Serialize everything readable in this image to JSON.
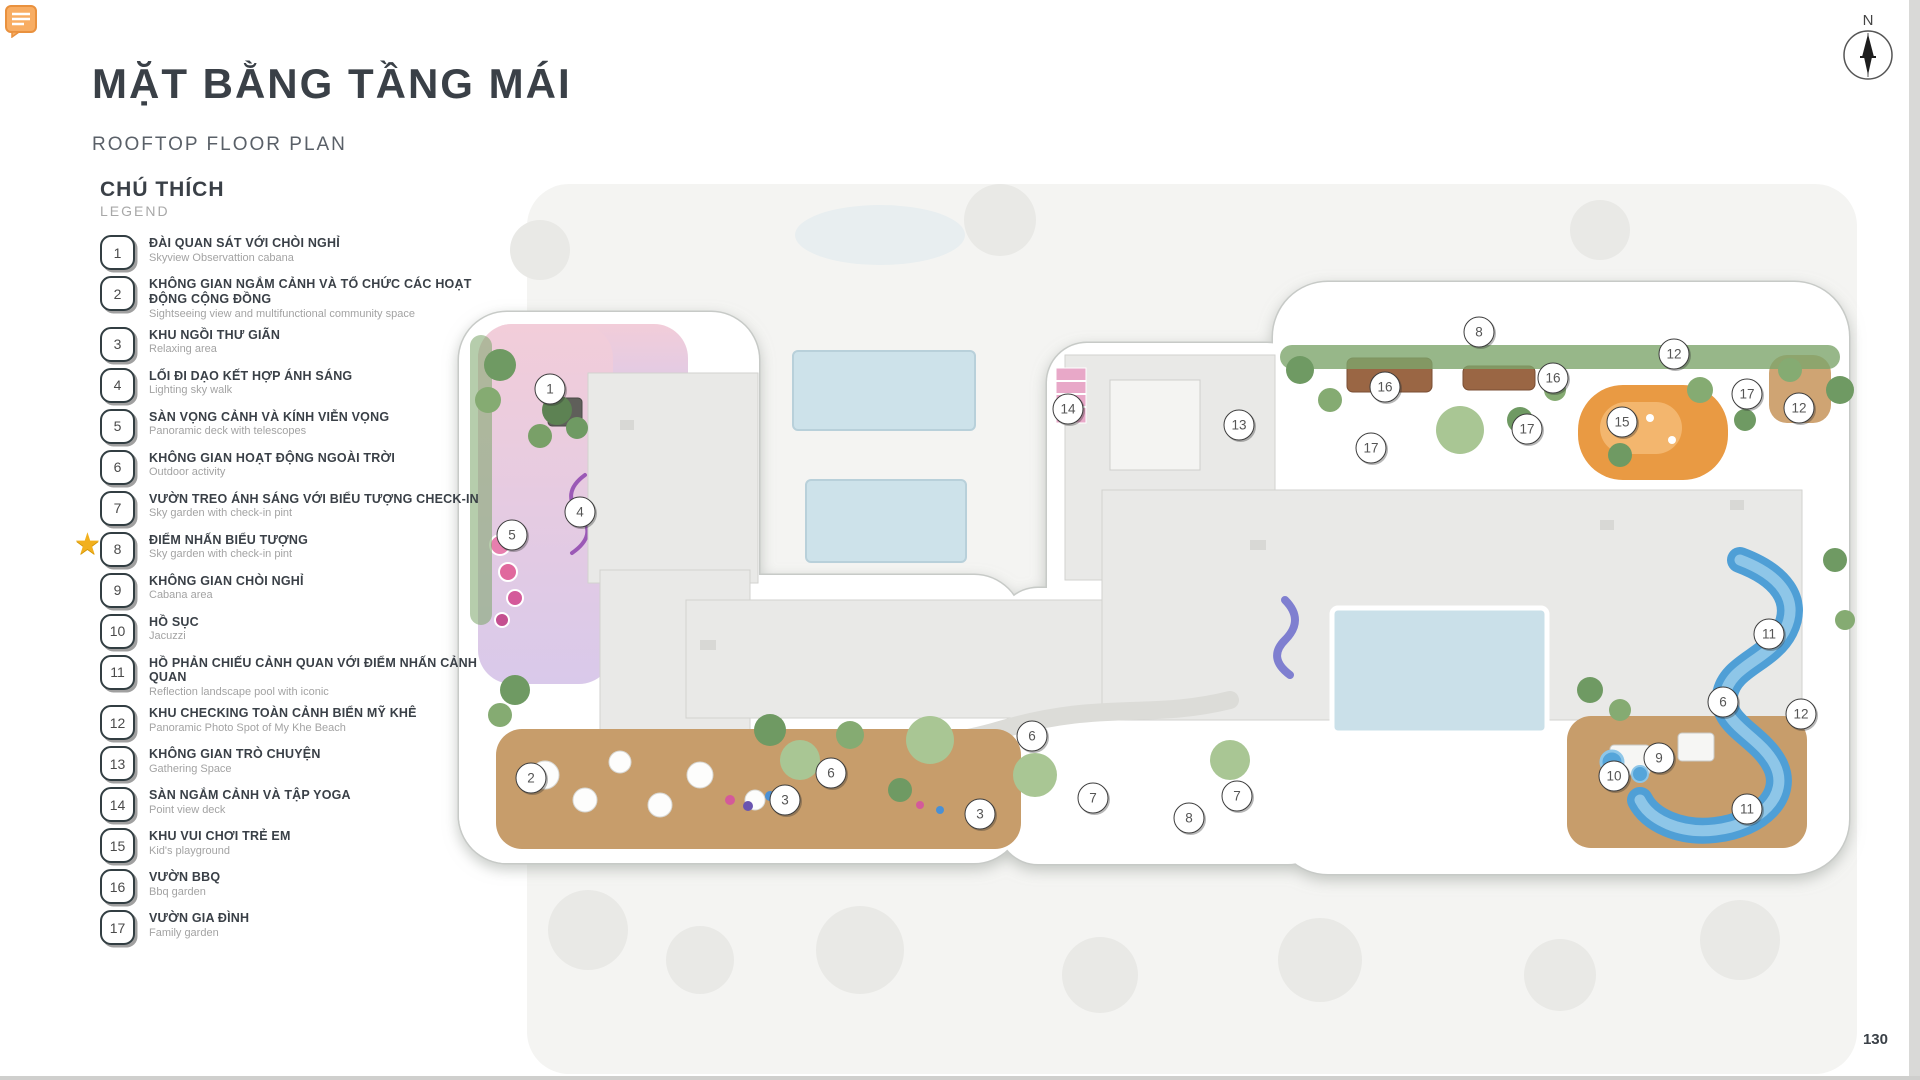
{
  "header": {
    "title_vi": "MẶT BẰNG TẦNG MÁI",
    "title_en": "ROOFTOP FLOOR PLAN"
  },
  "legend": {
    "title_vi": "CHÚ THÍCH",
    "title_en": "LEGEND",
    "items": [
      {
        "num": "1",
        "vi": "ĐÀI QUAN SÁT VỚI CHÒI NGHỈ",
        "en": "Skyview Observattion cabana",
        "starred": false
      },
      {
        "num": "2",
        "vi": "KHÔNG GIAN NGẮM CẢNH VÀ TỔ CHỨC CÁC HOẠT ĐỘNG CỘNG ĐỒNG",
        "en": "Sightseeing view and multifunctional community space",
        "starred": false
      },
      {
        "num": "3",
        "vi": "KHU NGỒI THƯ GIÃN",
        "en": "Relaxing area",
        "starred": false
      },
      {
        "num": "4",
        "vi": "LỐI ĐI DẠO KẾT HỢP ÁNH SÁNG",
        "en": "Lighting sky walk",
        "starred": false
      },
      {
        "num": "5",
        "vi": "SÀN VỌNG CẢNH VÀ KÍNH VIỄN VỌNG",
        "en": "Panoramic deck with telescopes",
        "starred": false
      },
      {
        "num": "6",
        "vi": "KHÔNG GIAN HOẠT ĐỘNG NGOÀI TRỜI",
        "en": "Outdoor activity",
        "starred": false
      },
      {
        "num": "7",
        "vi": "VƯỜN TREO ÁNH SÁNG VỚI BIỂU TƯỢNG CHECK-IN",
        "en": "Sky garden with check-in pint",
        "starred": false
      },
      {
        "num": "8",
        "vi": "ĐIỂM NHẤN BIỂU TƯỢNG",
        "en": "Sky garden with check-in pint",
        "starred": true
      },
      {
        "num": "9",
        "vi": "KHÔNG GIAN CHÒI NGHỈ",
        "en": "Cabana area",
        "starred": false
      },
      {
        "num": "10",
        "vi": "HỒ SỤC",
        "en": "Jacuzzi",
        "starred": false
      },
      {
        "num": "11",
        "vi": "HỒ PHẢN CHIẾU CẢNH QUAN VỚI ĐIỂM NHẤN CẢNH QUAN",
        "en": "Reflection landscape pool with iconic",
        "starred": false
      },
      {
        "num": "12",
        "vi": "KHU CHECKING TOÀN CẢNH BIỂN MỸ KHÊ",
        "en": "Panoramic Photo Spot of My Khe Beach",
        "starred": false
      },
      {
        "num": "13",
        "vi": "KHÔNG GIAN TRÒ CHUYỆN",
        "en": "Gathering Space",
        "starred": false
      },
      {
        "num": "14",
        "vi": "SÀN NGẮM CẢNH VÀ TẬP YOGA",
        "en": "Point view deck",
        "starred": false
      },
      {
        "num": "15",
        "vi": "KHU VUI CHƠI TRẺ EM",
        "en": "Kid's playground",
        "starred": false
      },
      {
        "num": "16",
        "vi": "VƯỜN BBQ",
        "en": "Bbq garden",
        "starred": false
      },
      {
        "num": "17",
        "vi": "VƯỜN GIA ĐÌNH",
        "en": "Family garden",
        "starred": false
      }
    ]
  },
  "compass": {
    "label": "N"
  },
  "page": {
    "number": "130"
  },
  "plan": {
    "markers": [
      {
        "num": "1",
        "x": 550,
        "y": 389
      },
      {
        "num": "4",
        "x": 580,
        "y": 512
      },
      {
        "num": "5",
        "x": 512,
        "y": 535
      },
      {
        "num": "2",
        "x": 531,
        "y": 778
      },
      {
        "num": "3",
        "x": 785,
        "y": 800
      },
      {
        "num": "6",
        "x": 831,
        "y": 773
      },
      {
        "num": "3",
        "x": 980,
        "y": 814
      },
      {
        "num": "6",
        "x": 1032,
        "y": 736
      },
      {
        "num": "7",
        "x": 1093,
        "y": 798
      },
      {
        "num": "8",
        "x": 1189,
        "y": 818
      },
      {
        "num": "7",
        "x": 1237,
        "y": 796
      },
      {
        "num": "14",
        "x": 1068,
        "y": 409
      },
      {
        "num": "13",
        "x": 1239,
        "y": 425
      },
      {
        "num": "16",
        "x": 1385,
        "y": 387
      },
      {
        "num": "17",
        "x": 1371,
        "y": 448
      },
      {
        "num": "16",
        "x": 1553,
        "y": 378
      },
      {
        "num": "17",
        "x": 1527,
        "y": 429
      },
      {
        "num": "8",
        "x": 1479,
        "y": 332
      },
      {
        "num": "15",
        "x": 1622,
        "y": 422
      },
      {
        "num": "12",
        "x": 1674,
        "y": 354
      },
      {
        "num": "17",
        "x": 1747,
        "y": 394
      },
      {
        "num": "12",
        "x": 1799,
        "y": 408
      },
      {
        "num": "11",
        "x": 1769,
        "y": 634
      },
      {
        "num": "6",
        "x": 1723,
        "y": 702
      },
      {
        "num": "12",
        "x": 1801,
        "y": 714
      },
      {
        "num": "9",
        "x": 1659,
        "y": 758
      },
      {
        "num": "10",
        "x": 1614,
        "y": 776
      },
      {
        "num": "11",
        "x": 1747,
        "y": 809
      }
    ]
  },
  "colors": {
    "title_text": "#3a4047",
    "legend_sub_text": "#a3a3a3",
    "star_gold": "#f2b01e",
    "roof_gray": "#e9e9e7",
    "deck_tan": "#c79d6b",
    "pool_pale_blue": "#cde2ea",
    "water_blue": "#4f9fd6",
    "landscape_green": "#6f9a63",
    "playground_orange": "#e99a43",
    "zone_pink": "#f2cdd9",
    "zone_lavender": "#d9c9ea",
    "comment_orange": "#f8ad63"
  }
}
